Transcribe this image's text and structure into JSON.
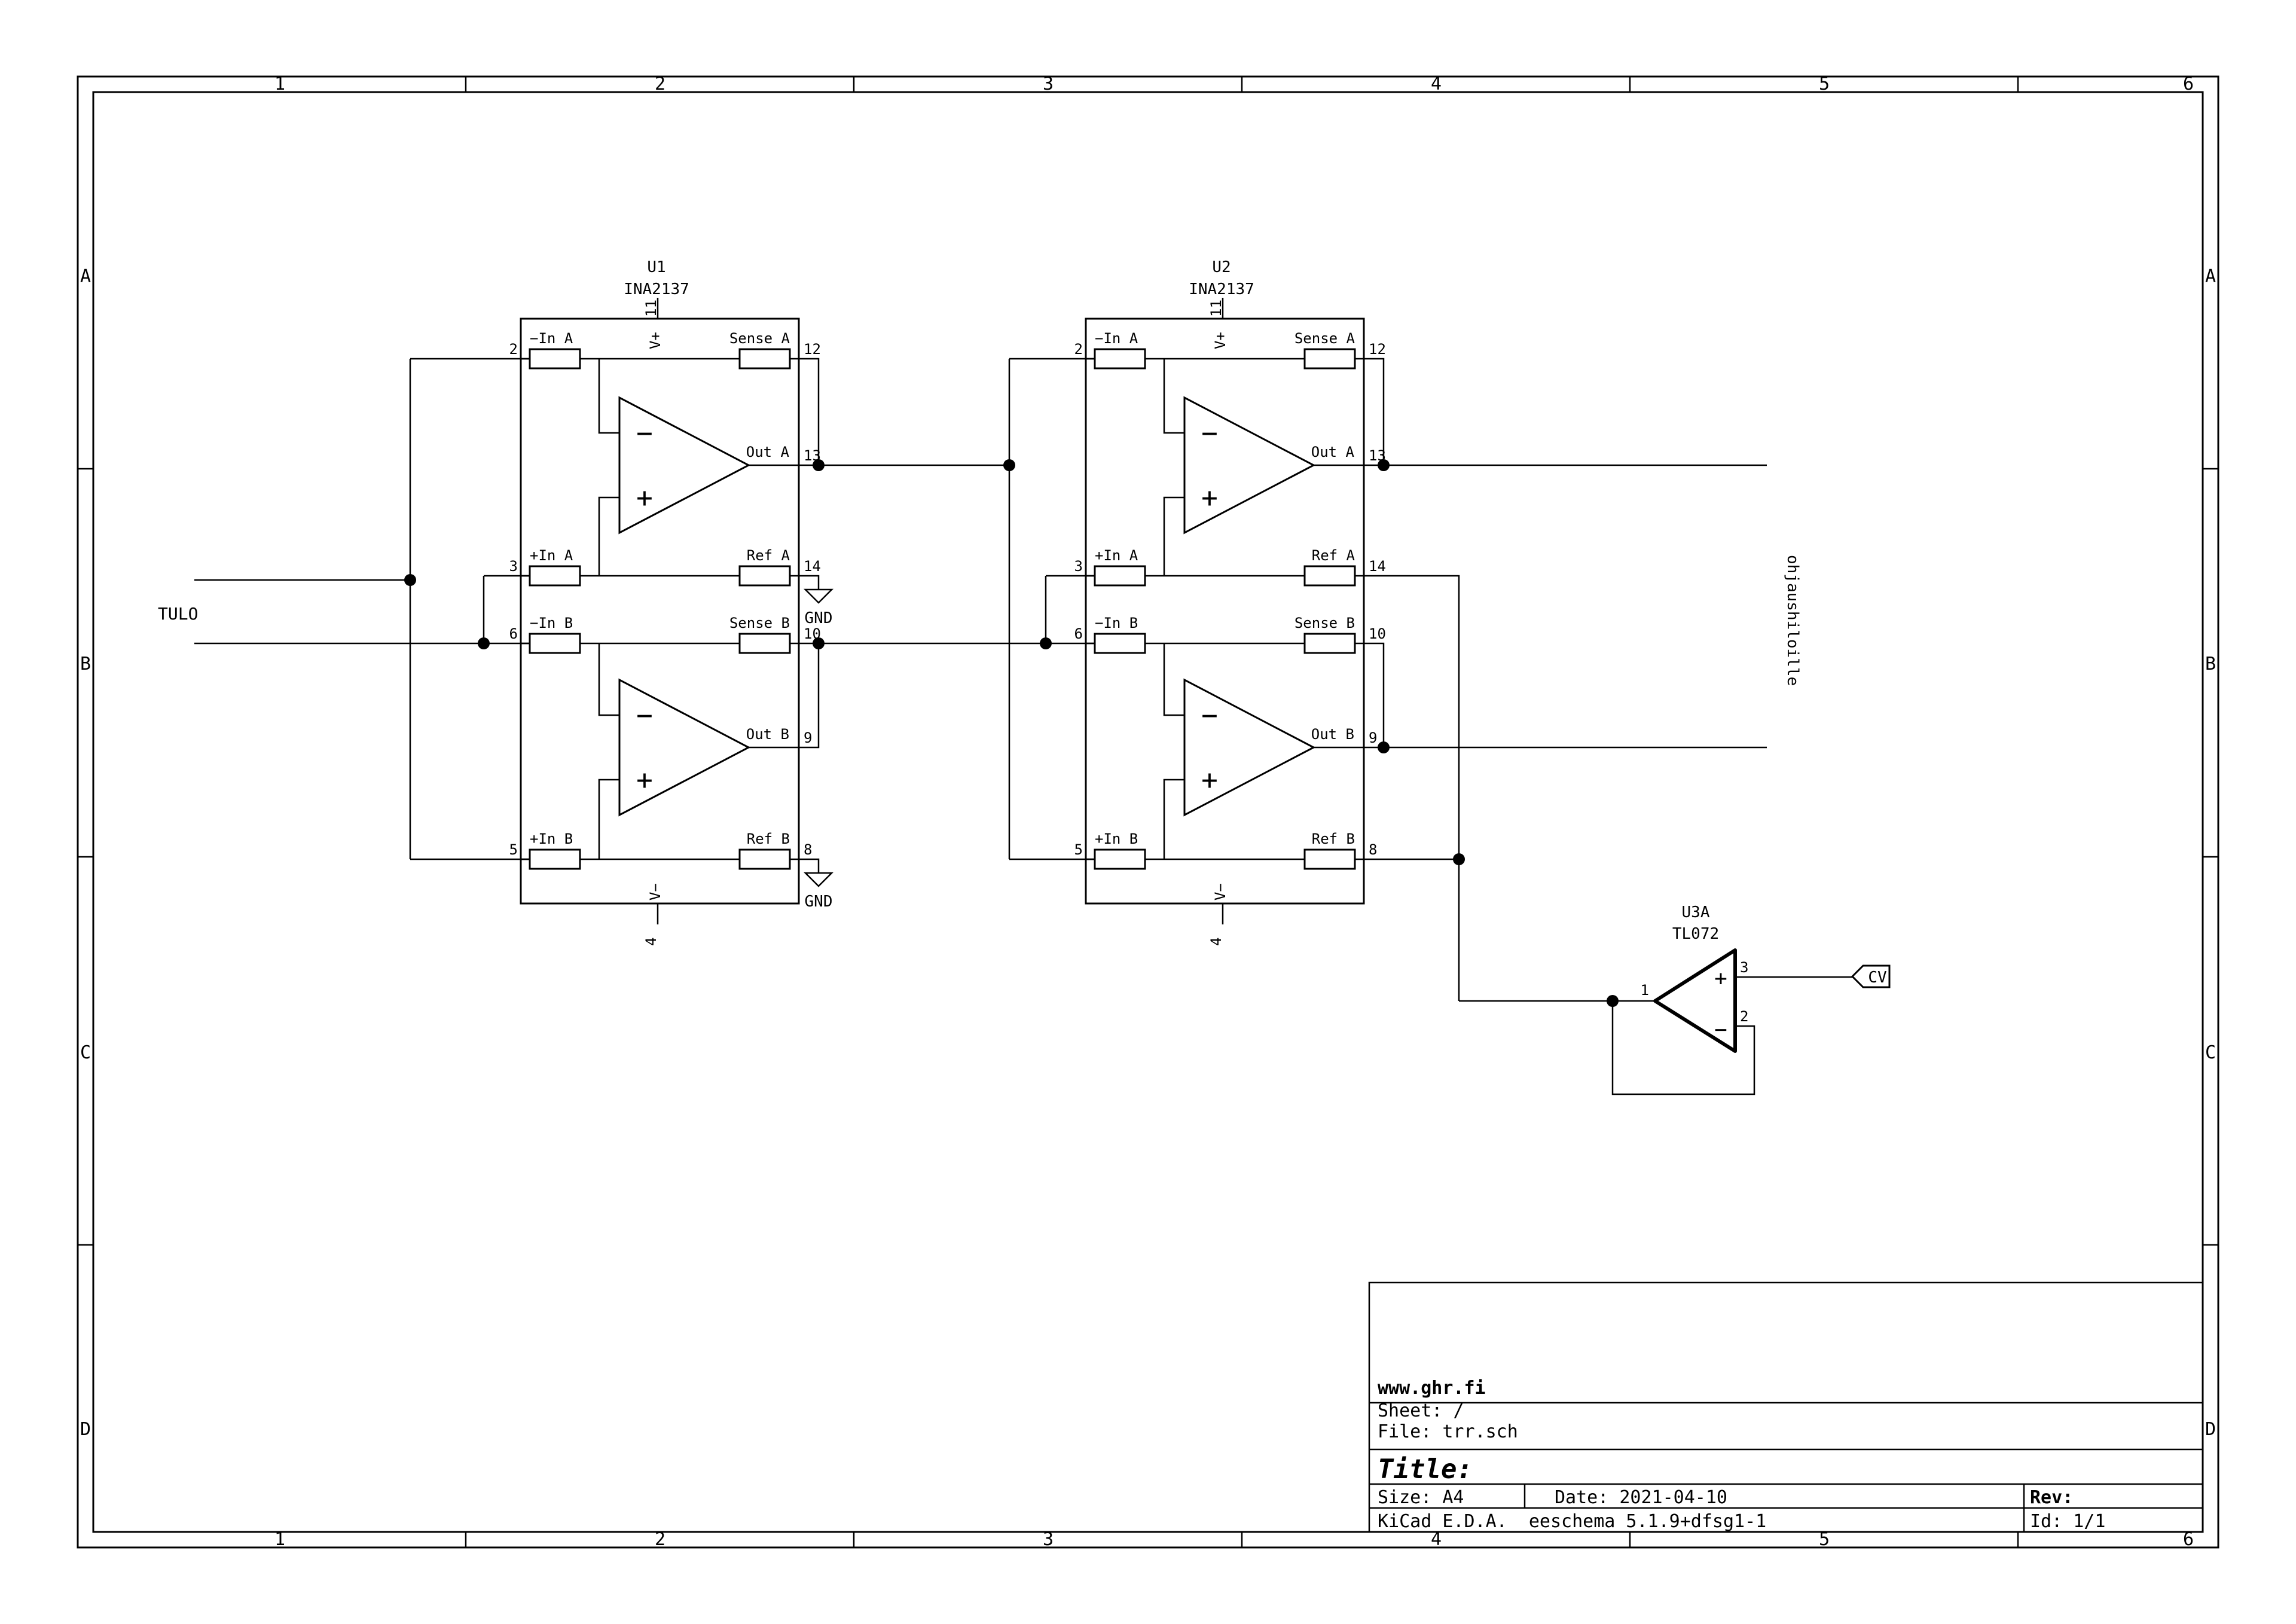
{
  "sheet": {
    "grid": {
      "columns": [
        "1",
        "2",
        "3",
        "4",
        "5",
        "6"
      ],
      "rows": [
        "A",
        "B",
        "C",
        "D"
      ]
    },
    "title_block": {
      "company": "www.ghr.fi",
      "sheet": "Sheet: /",
      "file": "File: trr.sch",
      "title_label": "Title:",
      "size": "Size: A4",
      "date": "Date: 2021-04-10",
      "rev_label": "Rev:",
      "tool": "KiCad E.D.A.  eeschema 5.1.9+dfsg1-1",
      "page_id": "Id: 1/1"
    }
  },
  "components": {
    "u1": {
      "ref": "U1",
      "value": "INA2137"
    },
    "u2": {
      "ref": "U2",
      "value": "INA2137"
    },
    "u3": {
      "ref": "U3A",
      "value": "TL072",
      "pin_out": "1",
      "pin_inv": "2",
      "pin_noninv": "3"
    }
  },
  "ina": {
    "labels": {
      "in_a_minus": "−In A",
      "sense_a": "Sense A",
      "in_a_plus": "+In A",
      "ref_a": "Ref A",
      "in_b_minus": "−In B",
      "sense_b": "Sense B",
      "in_b_plus": "+In B",
      "ref_b": "Ref B",
      "out_a": "Out A",
      "out_b": "Out B",
      "v_plus": "V+",
      "v_minus": "V−"
    },
    "pins": {
      "in_a_minus": "2",
      "sense_a": "12",
      "in_a_plus": "3",
      "ref_a": "14",
      "in_b_minus": "6",
      "sense_b": "10",
      "in_b_plus": "5",
      "ref_b": "8",
      "out_a": "13",
      "out_b": "9",
      "v_plus": "11",
      "v_minus": "4"
    }
  },
  "net_labels": {
    "input": "TULO",
    "cv": "CV",
    "annotation": "ohjaushiloille",
    "gnd": "GND"
  },
  "symbols": {
    "plus": "+",
    "minus": "−"
  },
  "colors": {
    "line": "#000000",
    "background": "#ffffff"
  }
}
